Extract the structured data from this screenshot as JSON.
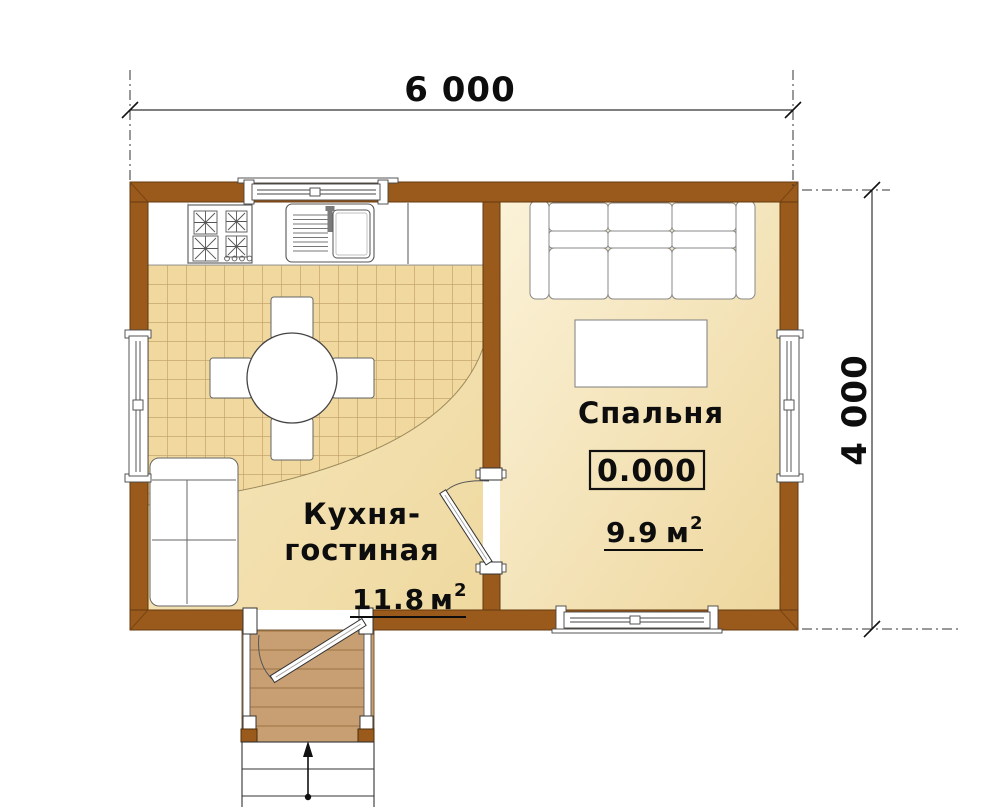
{
  "plan": {
    "dimensions": {
      "top_label": "6 000",
      "right_label": "4 000"
    },
    "rooms": {
      "kitchen": {
        "label_line1": "Кухня-",
        "label_line2": "гостиная",
        "area_value": "11.8",
        "area_unit": "м",
        "area_sup": "2"
      },
      "bedroom": {
        "label": "Спальня",
        "area_value": "9.9",
        "area_unit": "м",
        "area_sup": "2",
        "level_mark": "0.000"
      }
    }
  },
  "colors": {
    "wall": "#9A5A1C",
    "wall_edge": "#64390E",
    "tile_floor": "#F0D89E",
    "tile_line": "#BE9D64",
    "kitchen_floor": "#F3E2AE",
    "bedroom_floor_light": "#FBF2D8",
    "bedroom_floor_dark": "#EED79E",
    "porch_wood": "#C79F72",
    "porch_plank_line": "#A57C4C",
    "furniture_outline": "#777777",
    "dimension_line": "#333333",
    "text": "#0D0D0D"
  }
}
